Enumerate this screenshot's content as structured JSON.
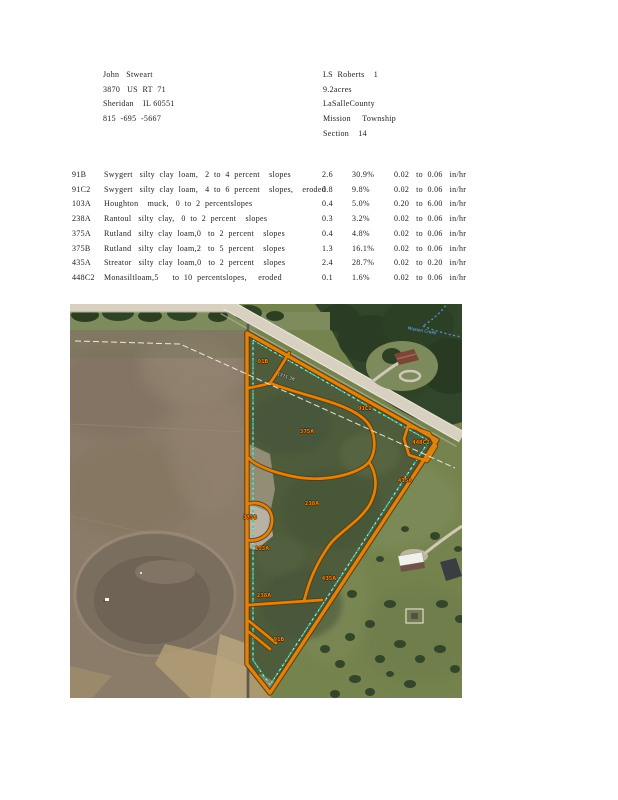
{
  "header": {
    "owner": {
      "lines": [
        "John   Stweart",
        "3870   US  RT  71",
        "Sheridan    IL 60551",
        "815  -695  -5667"
      ]
    },
    "parcel": {
      "lines": [
        "LS  Roberts    1",
        "9.2acres",
        "LaSalleCounty",
        "Mission     Township",
        "Section    14"
      ]
    }
  },
  "soil_table": {
    "rows": [
      {
        "code": "91B",
        "description": "Swygert   silty  clay  loam,   2  to  4  percent    slopes",
        "acres": "2.6",
        "percent": "30.9%",
        "permeability": "0.02   to  0.06   in/hr"
      },
      {
        "code": "91C2",
        "description": "Swygert   silty  clay  loam,   4  to  6  percent    slopes,    eroded",
        "acres": "0.8",
        "percent": "9.8%",
        "permeability": "0.02   to  0.06   in/hr"
      },
      {
        "code": "103A",
        "description": "Houghton    muck,   0  to  2  percentslopes",
        "acres": "0.4",
        "percent": "5.0%",
        "permeability": "0.20   to  6.00   in/hr"
      },
      {
        "code": "238A",
        "description": "Rantoul   silty  clay,   0  to  2  percent    slopes",
        "acres": "0.3",
        "percent": "3.2%",
        "permeability": "0.02   to  0.06   in/hr"
      },
      {
        "code": "375A",
        "description": "Rutland   silty  clay  loam,0   to  2  percent    slopes",
        "acres": "0.4",
        "percent": "4.8%",
        "permeability": "0.02   to  0.06   in/hr"
      },
      {
        "code": "375B",
        "description": "Rutland   silty  clay  loam,2   to  5  percent    slopes",
        "acres": "1.3",
        "percent": "16.1%",
        "permeability": "0.02   to  0.06   in/hr"
      },
      {
        "code": "435A",
        "description": "Streator   silty  clay  loam,0   to  2  percent    slopes",
        "acres": "2.4",
        "percent": "28.7%",
        "permeability": "0.02   to  0.20   in/hr"
      },
      {
        "code": "448C2",
        "description": "Monasiltloam,5      to  10  percentslopes,     eroded",
        "acres": "0.1",
        "percent": "1.6%",
        "permeability": "0.02   to  0.06   in/hr"
      }
    ]
  },
  "map": {
    "soil_labels": [
      {
        "code": "91B",
        "x": 193,
        "y": 58
      },
      {
        "code": "91C2",
        "x": 295,
        "y": 105
      },
      {
        "code": "375A",
        "x": 237,
        "y": 128
      },
      {
        "code": "448C2",
        "x": 351,
        "y": 139
      },
      {
        "code": "435A",
        "x": 335,
        "y": 177
      },
      {
        "code": "238A",
        "x": 242,
        "y": 200
      },
      {
        "code": "375B",
        "x": 180,
        "y": 214
      },
      {
        "code": "103A",
        "x": 192,
        "y": 245
      },
      {
        "code": "435A",
        "x": 259,
        "y": 275
      },
      {
        "code": "238A",
        "x": 194,
        "y": 292
      },
      {
        "code": "91B",
        "x": 209,
        "y": 336
      }
    ],
    "distance_label": {
      "text": "1371.3ft",
      "x": 216,
      "y": 73,
      "angle": 20
    },
    "stream_label": {
      "text": "Mission Creek",
      "x": 352,
      "y": 27,
      "angle": 10
    },
    "colors": {
      "boundary_orange": "#e0820c",
      "boundary_dark": "#5f3804",
      "inner_teal": "#2fc6a3",
      "label_orange": "#ff8a00",
      "road_tan": "#d8d0c1"
    }
  }
}
